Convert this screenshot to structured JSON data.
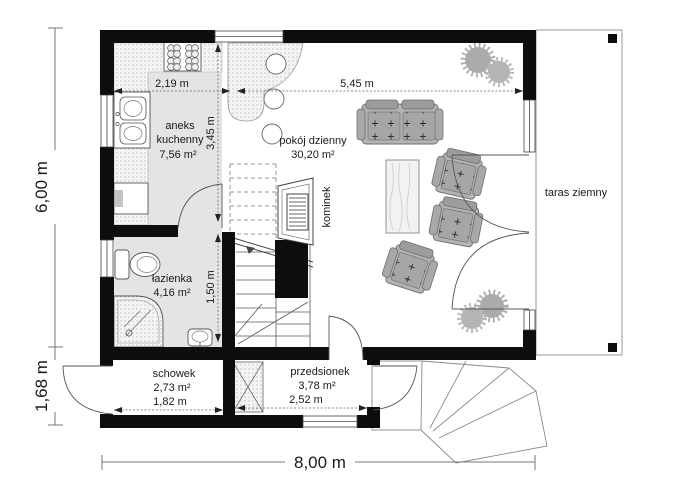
{
  "rooms": {
    "kitchen": {
      "line1": "aneks",
      "line2": "kuchenny",
      "area": "7,56 m²"
    },
    "living": {
      "name": "pokój dzienny",
      "area": "30,20 m²"
    },
    "bathroom": {
      "name": "łazienka",
      "area": "4,16 m²"
    },
    "storage": {
      "name": "schowek",
      "area": "2,73 m²"
    },
    "vestibule": {
      "name": "przedsionek",
      "area": "3,78 m²"
    }
  },
  "features": {
    "fireplace": "kominek",
    "terrace": "taras ziemny"
  },
  "dimensions": {
    "overall_width": "8,00 m",
    "main_depth": "6,00 m",
    "annex_depth": "1,68 m",
    "kitchen_width": "2,19 m",
    "living_width": "5,45 m",
    "kitchen_depth": "3,45 m",
    "bathroom_depth": "1,50 m",
    "storage_width": "1,82 m",
    "vestibule_width": "2,52 m"
  },
  "colors": {
    "wall": "#0d0d0d",
    "room_fill": "#e4e4e4",
    "counter_fill": "#f4f4f4",
    "furniture": "#b3b3b3",
    "cushion": "#a6a6a6",
    "plant": "#ababab",
    "outline": "#555555",
    "terrace_border": "#999999"
  }
}
